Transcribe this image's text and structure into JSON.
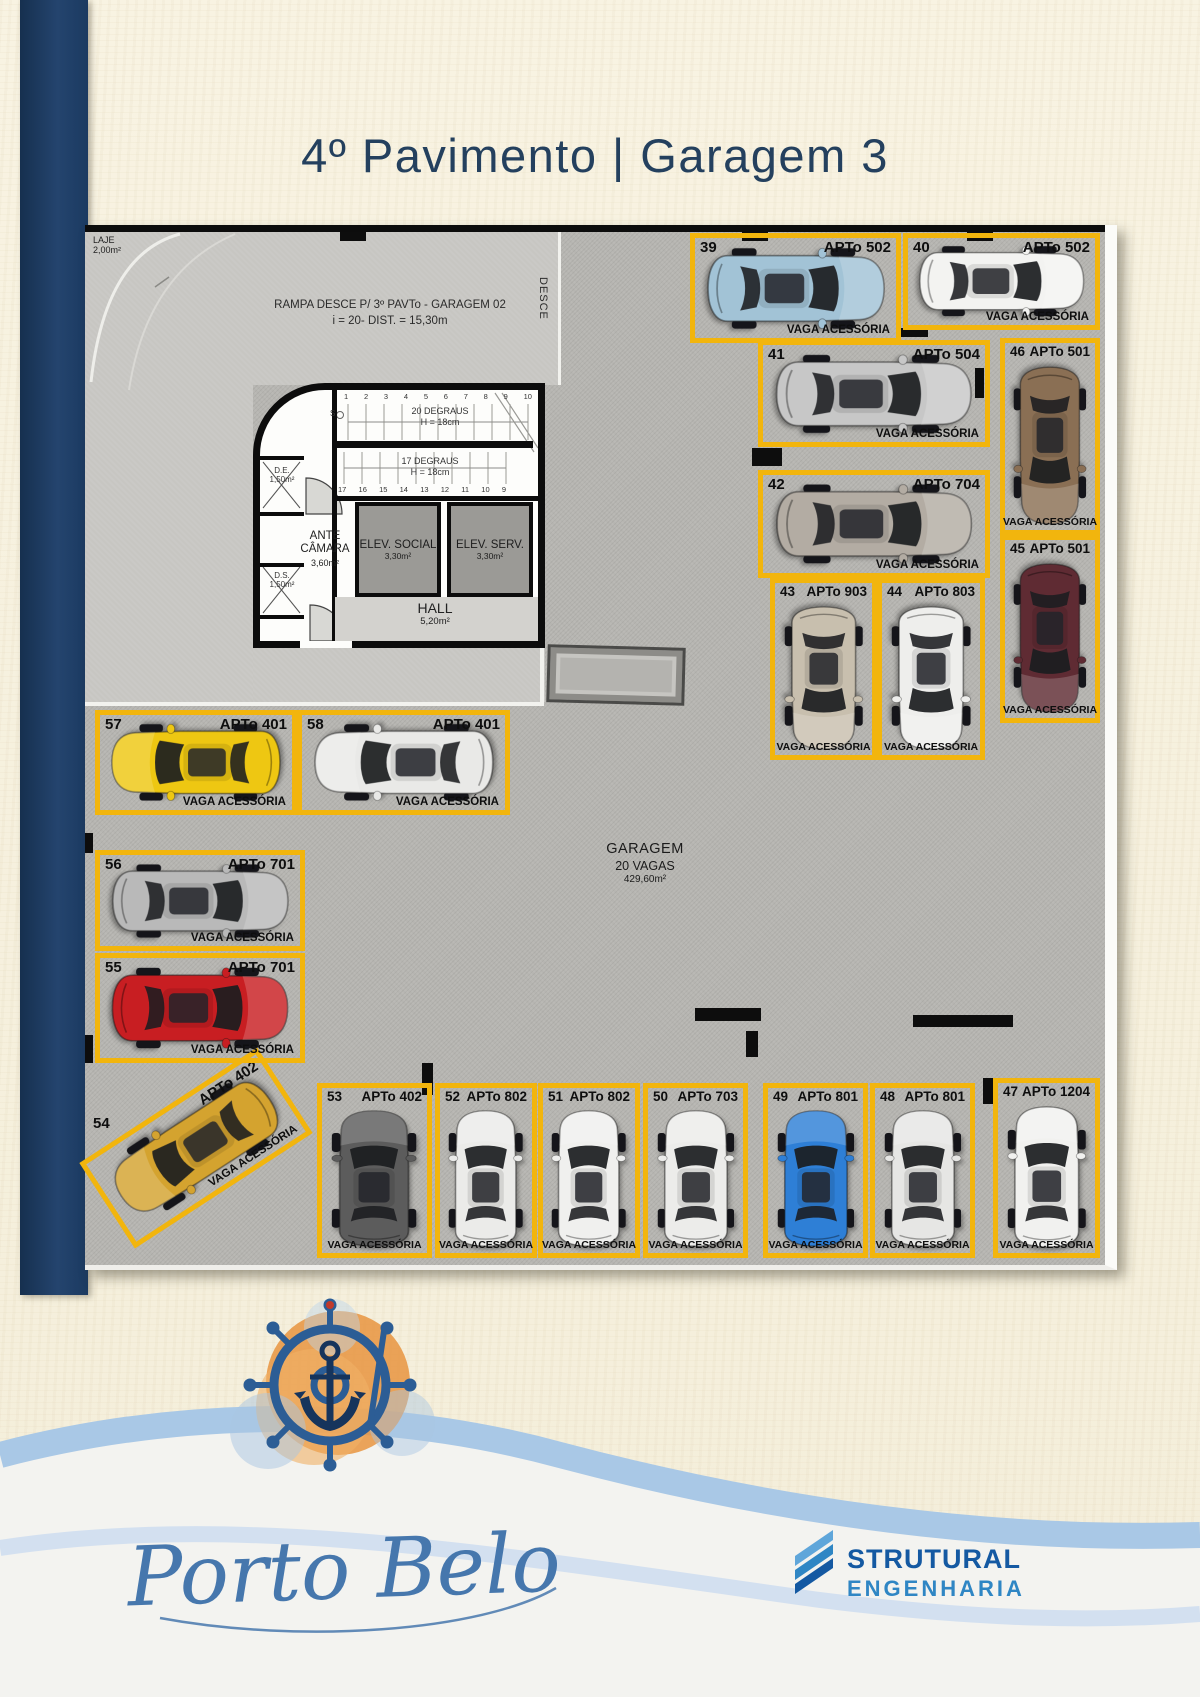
{
  "page": {
    "title": "4º Pavimento | Garagem 3"
  },
  "plan": {
    "laje_line1": "LAJE",
    "laje_line2": "2,00m²",
    "ramp_line1": "RAMPA DESCE P/ 3º PAVTo - GARAGEM 02",
    "ramp_line2": "i = 20- DIST. = 15,30m",
    "desce_label": "DESCE",
    "garagem_line1": "GARAGEM",
    "garagem_line2": "20 VAGAS",
    "garagem_line3": "429,60m²",
    "vaga_label": "VAGA ACESSÓRIA",
    "core": {
      "s_label": "S",
      "stair_numbers_top": [
        "1",
        "2",
        "3",
        "4",
        "5",
        "6",
        "7",
        "8",
        "9",
        "10"
      ],
      "stairs_up_line1": "20 DEGRAUS",
      "stairs_up_line2": "H = 18cm",
      "stairs_down_line1": "17 DEGRAUS",
      "stairs_down_line2": "H = 18cm",
      "stair_numbers_bottom": [
        "17",
        "16",
        "15",
        "14",
        "13",
        "12",
        "11",
        "10",
        "9"
      ],
      "de_line1": "D.E.",
      "de_line2": "1,50m²",
      "ds_line1": "D.S.",
      "ds_line2": "1,50m²",
      "ante_line1": "ANTE",
      "ante_line2": "CÂMARA",
      "ante_line3": "3,60m²",
      "elev_social_line1": "ELEV. SOCIAL",
      "elev_social_line2": "3,30m²",
      "elev_serv_line1": "ELEV. SERV.",
      "elev_serv_line2": "3,30m²",
      "hall_line1": "HALL",
      "hall_line2": "5,20m²"
    },
    "spots": [
      {
        "num": "39",
        "apt": "APTo 502",
        "car_color": "#a2c3d6"
      },
      {
        "num": "40",
        "apt": "APTo 502",
        "car_color": "#f3f3f1"
      },
      {
        "num": "41",
        "apt": "APTo 504",
        "car_color": "#c7c7c7"
      },
      {
        "num": "42",
        "apt": "APTo 704",
        "car_color": "#b3aca3"
      },
      {
        "num": "43",
        "apt": "APTo 903",
        "car_color": "#c8bfae"
      },
      {
        "num": "44",
        "apt": "APTo 803",
        "car_color": "#eeeeec"
      },
      {
        "num": "45",
        "apt": "APTo 501",
        "car_color": "#5f2b33"
      },
      {
        "num": "46",
        "apt": "APTo 501",
        "car_color": "#8a6f54"
      },
      {
        "num": "47",
        "apt": "APTo 1204",
        "car_color": "#f1f1ef"
      },
      {
        "num": "48",
        "apt": "APTo 801",
        "car_color": "#e6e6e4"
      },
      {
        "num": "49",
        "apt": "APTo 801",
        "car_color": "#2e7fd6"
      },
      {
        "num": "50",
        "apt": "APTo 703",
        "car_color": "#ececea"
      },
      {
        "num": "51",
        "apt": "APTo 802",
        "car_color": "#f0f0ee"
      },
      {
        "num": "52",
        "apt": "APTo 802",
        "car_color": "#ebebe9"
      },
      {
        "num": "53",
        "apt": "APTo 402",
        "car_color": "#5c5c5c"
      },
      {
        "num": "54",
        "apt": "APTo 402",
        "car_color": "#d4a32f"
      },
      {
        "num": "55",
        "apt": "APTo 701",
        "car_color": "#c81e22"
      },
      {
        "num": "56",
        "apt": "APTo 701",
        "car_color": "#b9b9b9"
      },
      {
        "num": "57",
        "apt": "APTo 401",
        "car_color": "#eec712"
      },
      {
        "num": "58",
        "apt": "APTo 401",
        "car_color": "#e9e9e7"
      }
    ]
  },
  "footer": {
    "brand_script": "Porto Belo",
    "company_line1": "STRUTURAL",
    "company_line2": "ENGENHARIA"
  },
  "colors": {
    "accent_yellow": "#f2b50d",
    "navy": "#1d3a63",
    "title_blue": "#24405e",
    "wave_blue": "#a9c8e6"
  }
}
